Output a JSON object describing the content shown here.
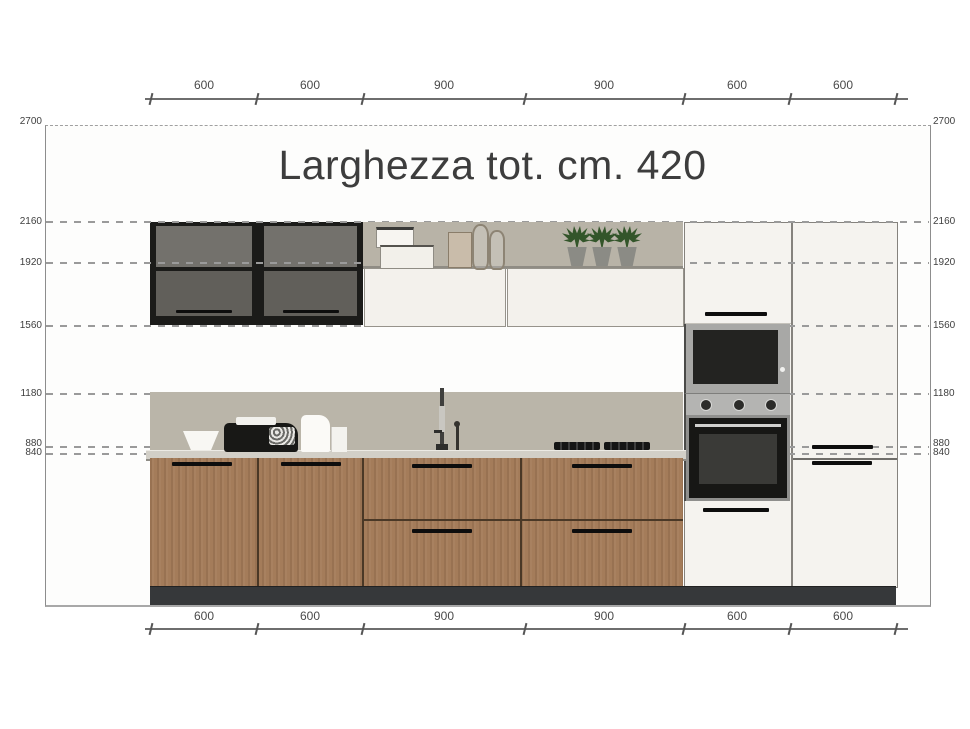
{
  "title": "Larghezza tot. cm. 420",
  "dimensions": {
    "top_labels": [
      "600",
      "600",
      "900",
      "900",
      "600",
      "600"
    ],
    "bottom_labels": [
      "600",
      "600",
      "900",
      "900",
      "600",
      "600"
    ],
    "left_labels": [
      "2700",
      "2160",
      "1920",
      "1560",
      "1180",
      "880",
      "840"
    ],
    "right_labels": [
      "2700",
      "2160",
      "1920",
      "1560",
      "1180",
      "880",
      "840"
    ]
  },
  "colors": {
    "wood": "#a47c5a",
    "backsplash_taupe": "#bab5a9",
    "dark_cabinet_frame": "#1b1b19",
    "glass_door_gray": "#73716c",
    "countertop": "#d2cfc7",
    "plinth": "#36383a",
    "white_cabinet": "#f5f3ef",
    "appliance_steel": "#a8a8a6",
    "oven_black": "#171715",
    "plant_green": "#33552a",
    "dimension_text": "#4a4a4a"
  },
  "legend": {
    "drawing_type": "kitchen elevation with dimensions in mm",
    "total_width_mm": 4200
  }
}
